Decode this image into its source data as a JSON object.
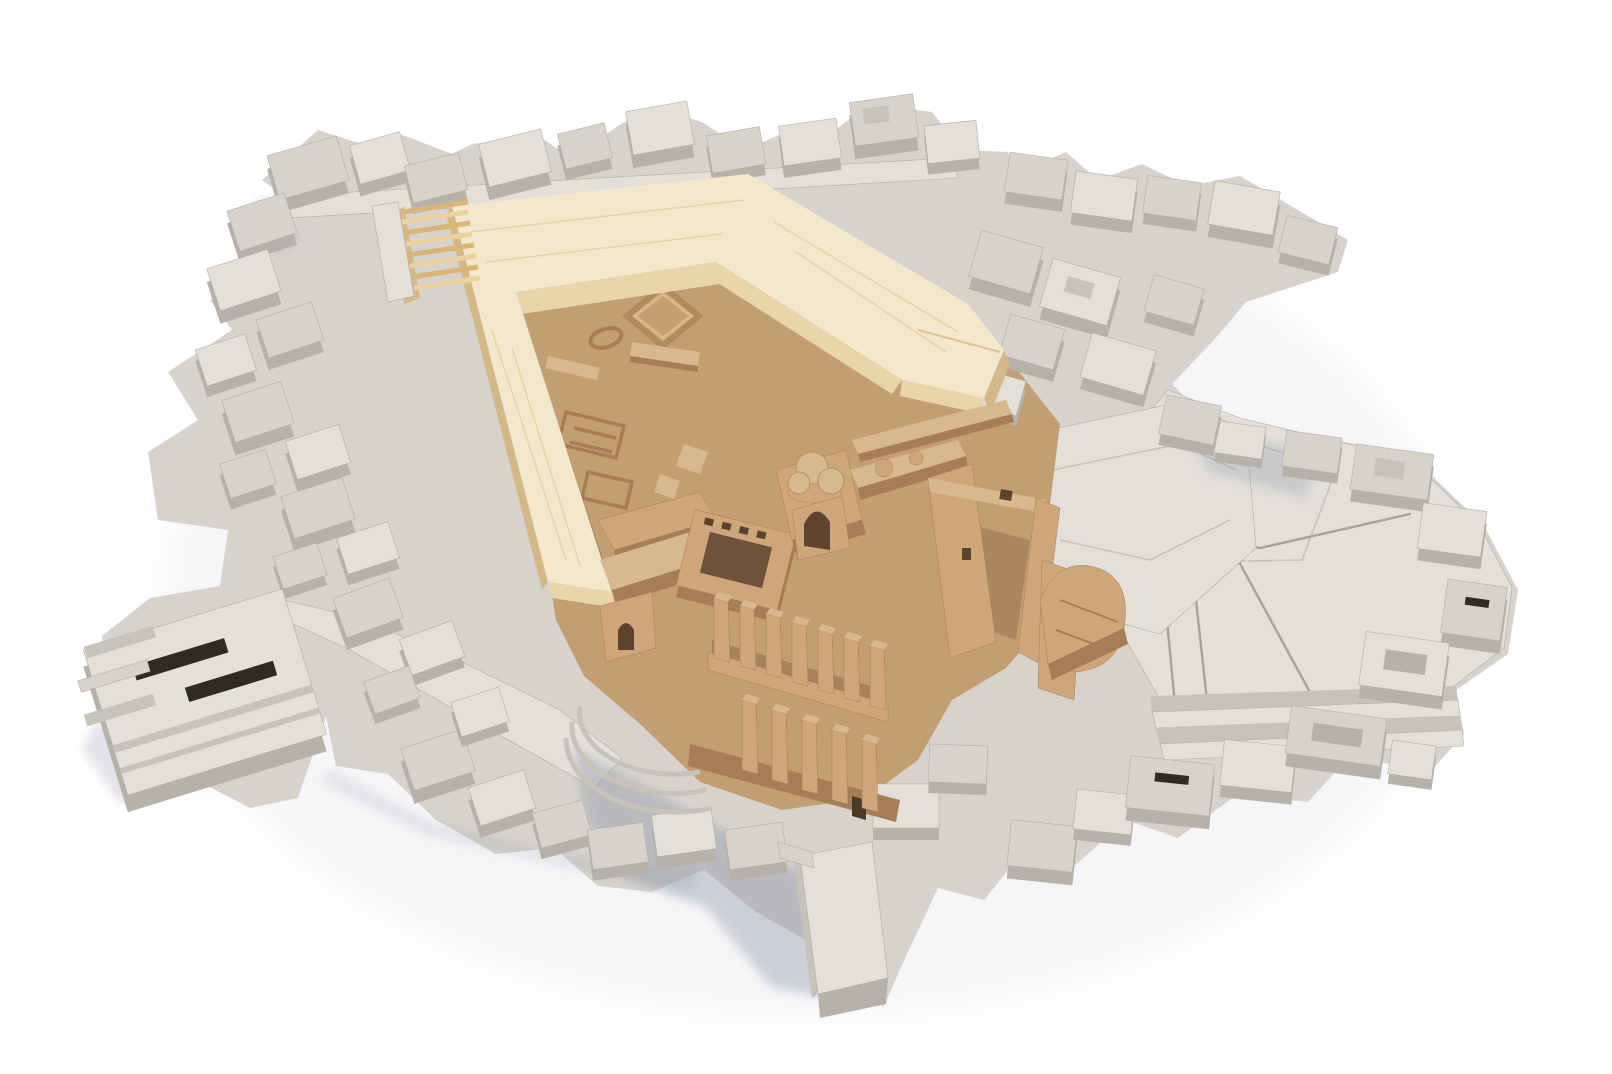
{
  "meta": {
    "title": "Architectural site model photograph",
    "description": "Top-down studio photograph of a physical architectural site model on a white background: grey chipboard city blocks and terraced terrain surround a tan cardboard excavation plaza containing a ruined cathedral, with a new L-shaped proposal building and grand stair made of light balsa wood at the upper left."
  },
  "scene": {
    "background": "seamless white studio backdrop",
    "elements": [
      {
        "name": "context-city-blocks",
        "material": "grey chipboard",
        "position": "perimeter on all sides"
      },
      {
        "name": "terraced-terrain",
        "material": "grey chipboard layers",
        "position": "right and lower-right"
      },
      {
        "name": "site-plaza",
        "material": "tan cardboard",
        "position": "center"
      },
      {
        "name": "cathedral-ruin",
        "material": "tan cardboard",
        "position": "center, with buttressed walls, cloister, trefoil gable and arch"
      },
      {
        "name": "proposal-building",
        "material": "light balsa wood",
        "shape": "L-shaped bar with grand stair",
        "position": "upper left of plaza"
      },
      {
        "name": "slotted-slab-building",
        "material": "grey chipboard",
        "position": "lower left"
      },
      {
        "name": "cast-shadows",
        "direction": "falling toward lower-left"
      }
    ]
  },
  "palette": {
    "bg": "#ffffff",
    "halo": "#d9dae2",
    "grey-top": "#d7d3cc",
    "grey-top-bright": "#e3e0da",
    "grey-front": "#b7b2a9",
    "grey-side": "#c8c3ba",
    "grey-dark": "#958e83",
    "grey-edge": "#b2ada3",
    "groove": "#a8a298",
    "slot-dark": "#2e2a24",
    "tan-ground": "#c49e73",
    "tan-light": "#d8b98d",
    "tan-wall": "#cda77b",
    "tan-wall-dark": "#a67e55",
    "tan-deep": "#5c432e",
    "tan-eave": "#8a6740",
    "wood-top": "#f3e8cc",
    "wood-side": "#e8d5a9",
    "wood-shade": "#d4b887",
    "wood-grain": "#e2cd9e",
    "wood-stair-a": "#e9d3a2",
    "wood-stair-b": "#d9b678",
    "shadow-blue": "#8f97ab",
    "shadow-soft": "#c2c0c6"
  }
}
